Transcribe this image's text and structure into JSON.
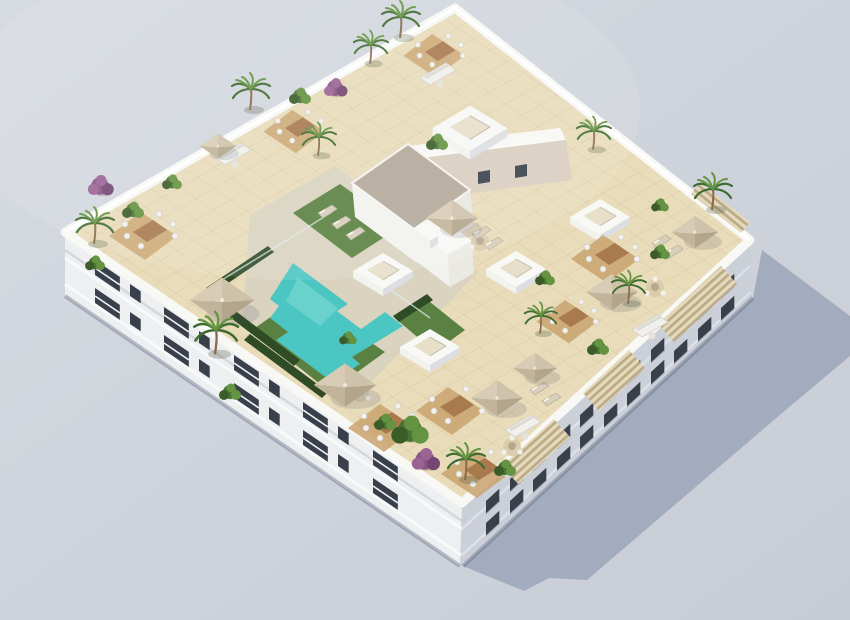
{
  "scene": {
    "label": "Aerial 3D rendering of a white apartment block with rooftop terraces, L-shaped swimming pool, lawns, parasols, pergolas and plants on a plain grey backdrop"
  },
  "colors": {
    "background": "#ced2da",
    "backgroundLight": "#d6d9e0",
    "shadow": "#a0a9bd",
    "tile": "#e9dcba",
    "deck": "#dad3c0",
    "wall": "#f8f8f5",
    "wallShade": "#dcdee3",
    "stucco": "#d8cec0",
    "facadeLeft": "#edeff1",
    "facadeRight": "#cbd0d8",
    "windowDark": "#39404b",
    "pool": "#4cc6c2",
    "poolLight": "#8ee0da",
    "lawn": "#5a8141",
    "hedge": "#2f4c27",
    "gravel": "#b3a79a",
    "parasol": "#cfc2ab",
    "parasolShade": "#b2a58c",
    "wood": "#a87a4e",
    "woodDeck": "#c9a36f",
    "pergola": "#e5d9ba",
    "pergolaSlat": "#b9aa87",
    "palm": "#3f6c30",
    "palmLight": "#649341",
    "bush": "#4a7433",
    "purple": "#8a5585",
    "furniture": "#f1f0ec",
    "trunk": "#8a6a4a",
    "glass": "#ddeeec"
  },
  "objects": {
    "skylights": [
      [
        470,
        127,
        1.25
      ],
      [
        600,
        216,
        1
      ],
      [
        516,
        268,
        1
      ],
      [
        383,
        270,
        1
      ],
      [
        430,
        346,
        1
      ]
    ],
    "parasols": [
      [
        222,
        300,
        1.25
      ],
      [
        345,
        385,
        1.2
      ],
      [
        452,
        218,
        1
      ],
      [
        695,
        232,
        0.9
      ],
      [
        612,
        292,
        1
      ],
      [
        497,
        398,
        1
      ],
      [
        535,
        368,
        0.85
      ],
      [
        218,
        146,
        0.7
      ]
    ],
    "palms": [
      [
        400,
        36,
        1
      ],
      [
        370,
        62,
        0.9
      ],
      [
        250,
        108,
        1
      ],
      [
        318,
        154,
        0.9
      ],
      [
        94,
        242,
        1
      ],
      [
        215,
        352,
        1.15
      ],
      [
        712,
        208,
        1
      ],
      [
        628,
        302,
        0.9
      ],
      [
        540,
        332,
        0.85
      ],
      [
        465,
        478,
        1
      ],
      [
        593,
        148,
        0.9
      ]
    ],
    "bushes": [
      [
        133,
        210,
        1
      ],
      [
        172,
        182,
        0.9
      ],
      [
        300,
        96,
        1
      ],
      [
        437,
        142,
        1
      ],
      [
        95,
        263,
        0.9
      ],
      [
        230,
        392,
        1
      ],
      [
        410,
        430,
        1.7
      ],
      [
        385,
        422,
        1
      ],
      [
        545,
        278,
        0.9
      ],
      [
        598,
        347,
        1
      ],
      [
        660,
        252,
        0.9
      ],
      [
        505,
        468,
        1
      ],
      [
        660,
        205,
        0.8
      ],
      [
        348,
        338,
        0.8
      ]
    ],
    "purple_shrubs": [
      [
        100,
        186,
        1.1
      ],
      [
        335,
        88,
        1
      ],
      [
        425,
        460,
        1.2
      ]
    ],
    "dining_sets": [
      [
        133,
        232,
        1
      ],
      [
        285,
        128,
        0.9
      ],
      [
        425,
        52,
        0.9
      ],
      [
        595,
        255,
        1
      ],
      [
        372,
        424,
        1
      ],
      [
        440,
        407,
        1
      ],
      [
        465,
        470,
        1
      ],
      [
        558,
        318,
        0.9
      ]
    ],
    "round_tables": [
      [
        480,
        242,
        1
      ],
      [
        655,
        288,
        1
      ],
      [
        360,
        393,
        1
      ],
      [
        512,
        447,
        1
      ]
    ],
    "sofas": [
      [
        420,
        78,
        1
      ],
      [
        215,
        158,
        1
      ],
      [
        632,
        330,
        1
      ],
      [
        505,
        430,
        1
      ]
    ],
    "loungers": [
      [
        318,
        213,
        1
      ],
      [
        332,
        224,
        1
      ],
      [
        346,
        235,
        1
      ],
      [
        652,
        243,
        1
      ],
      [
        664,
        253,
        1
      ],
      [
        472,
        234,
        1
      ],
      [
        484,
        245,
        1
      ],
      [
        530,
        390,
        1
      ],
      [
        542,
        401,
        1
      ]
    ],
    "balconies_left": [
      [
        95,
        260
      ],
      [
        164,
        307
      ],
      [
        234,
        355
      ],
      [
        303,
        402
      ],
      [
        373,
        450
      ],
      [
        95,
        288
      ],
      [
        164,
        335
      ],
      [
        234,
        383
      ],
      [
        303,
        430
      ],
      [
        373,
        478
      ]
    ],
    "windows_left": [
      [
        130,
        284
      ],
      [
        199,
        331
      ],
      [
        269,
        379
      ],
      [
        338,
        426
      ],
      [
        130,
        312
      ],
      [
        199,
        359
      ],
      [
        269,
        407
      ],
      [
        338,
        454
      ]
    ],
    "windows_right": [
      [
        486,
        501
      ],
      [
        510,
        479
      ],
      [
        533,
        458
      ],
      [
        557,
        436
      ],
      [
        580,
        415
      ],
      [
        604,
        393
      ],
      [
        627,
        372
      ],
      [
        651,
        350
      ],
      [
        674,
        329
      ],
      [
        698,
        307
      ],
      [
        721,
        286
      ],
      [
        486,
        523
      ],
      [
        510,
        501
      ],
      [
        533,
        480
      ],
      [
        557,
        458
      ],
      [
        580,
        437
      ],
      [
        604,
        415
      ],
      [
        627,
        394
      ],
      [
        651,
        372
      ],
      [
        674,
        351
      ],
      [
        698,
        329
      ],
      [
        721,
        308
      ]
    ]
  }
}
